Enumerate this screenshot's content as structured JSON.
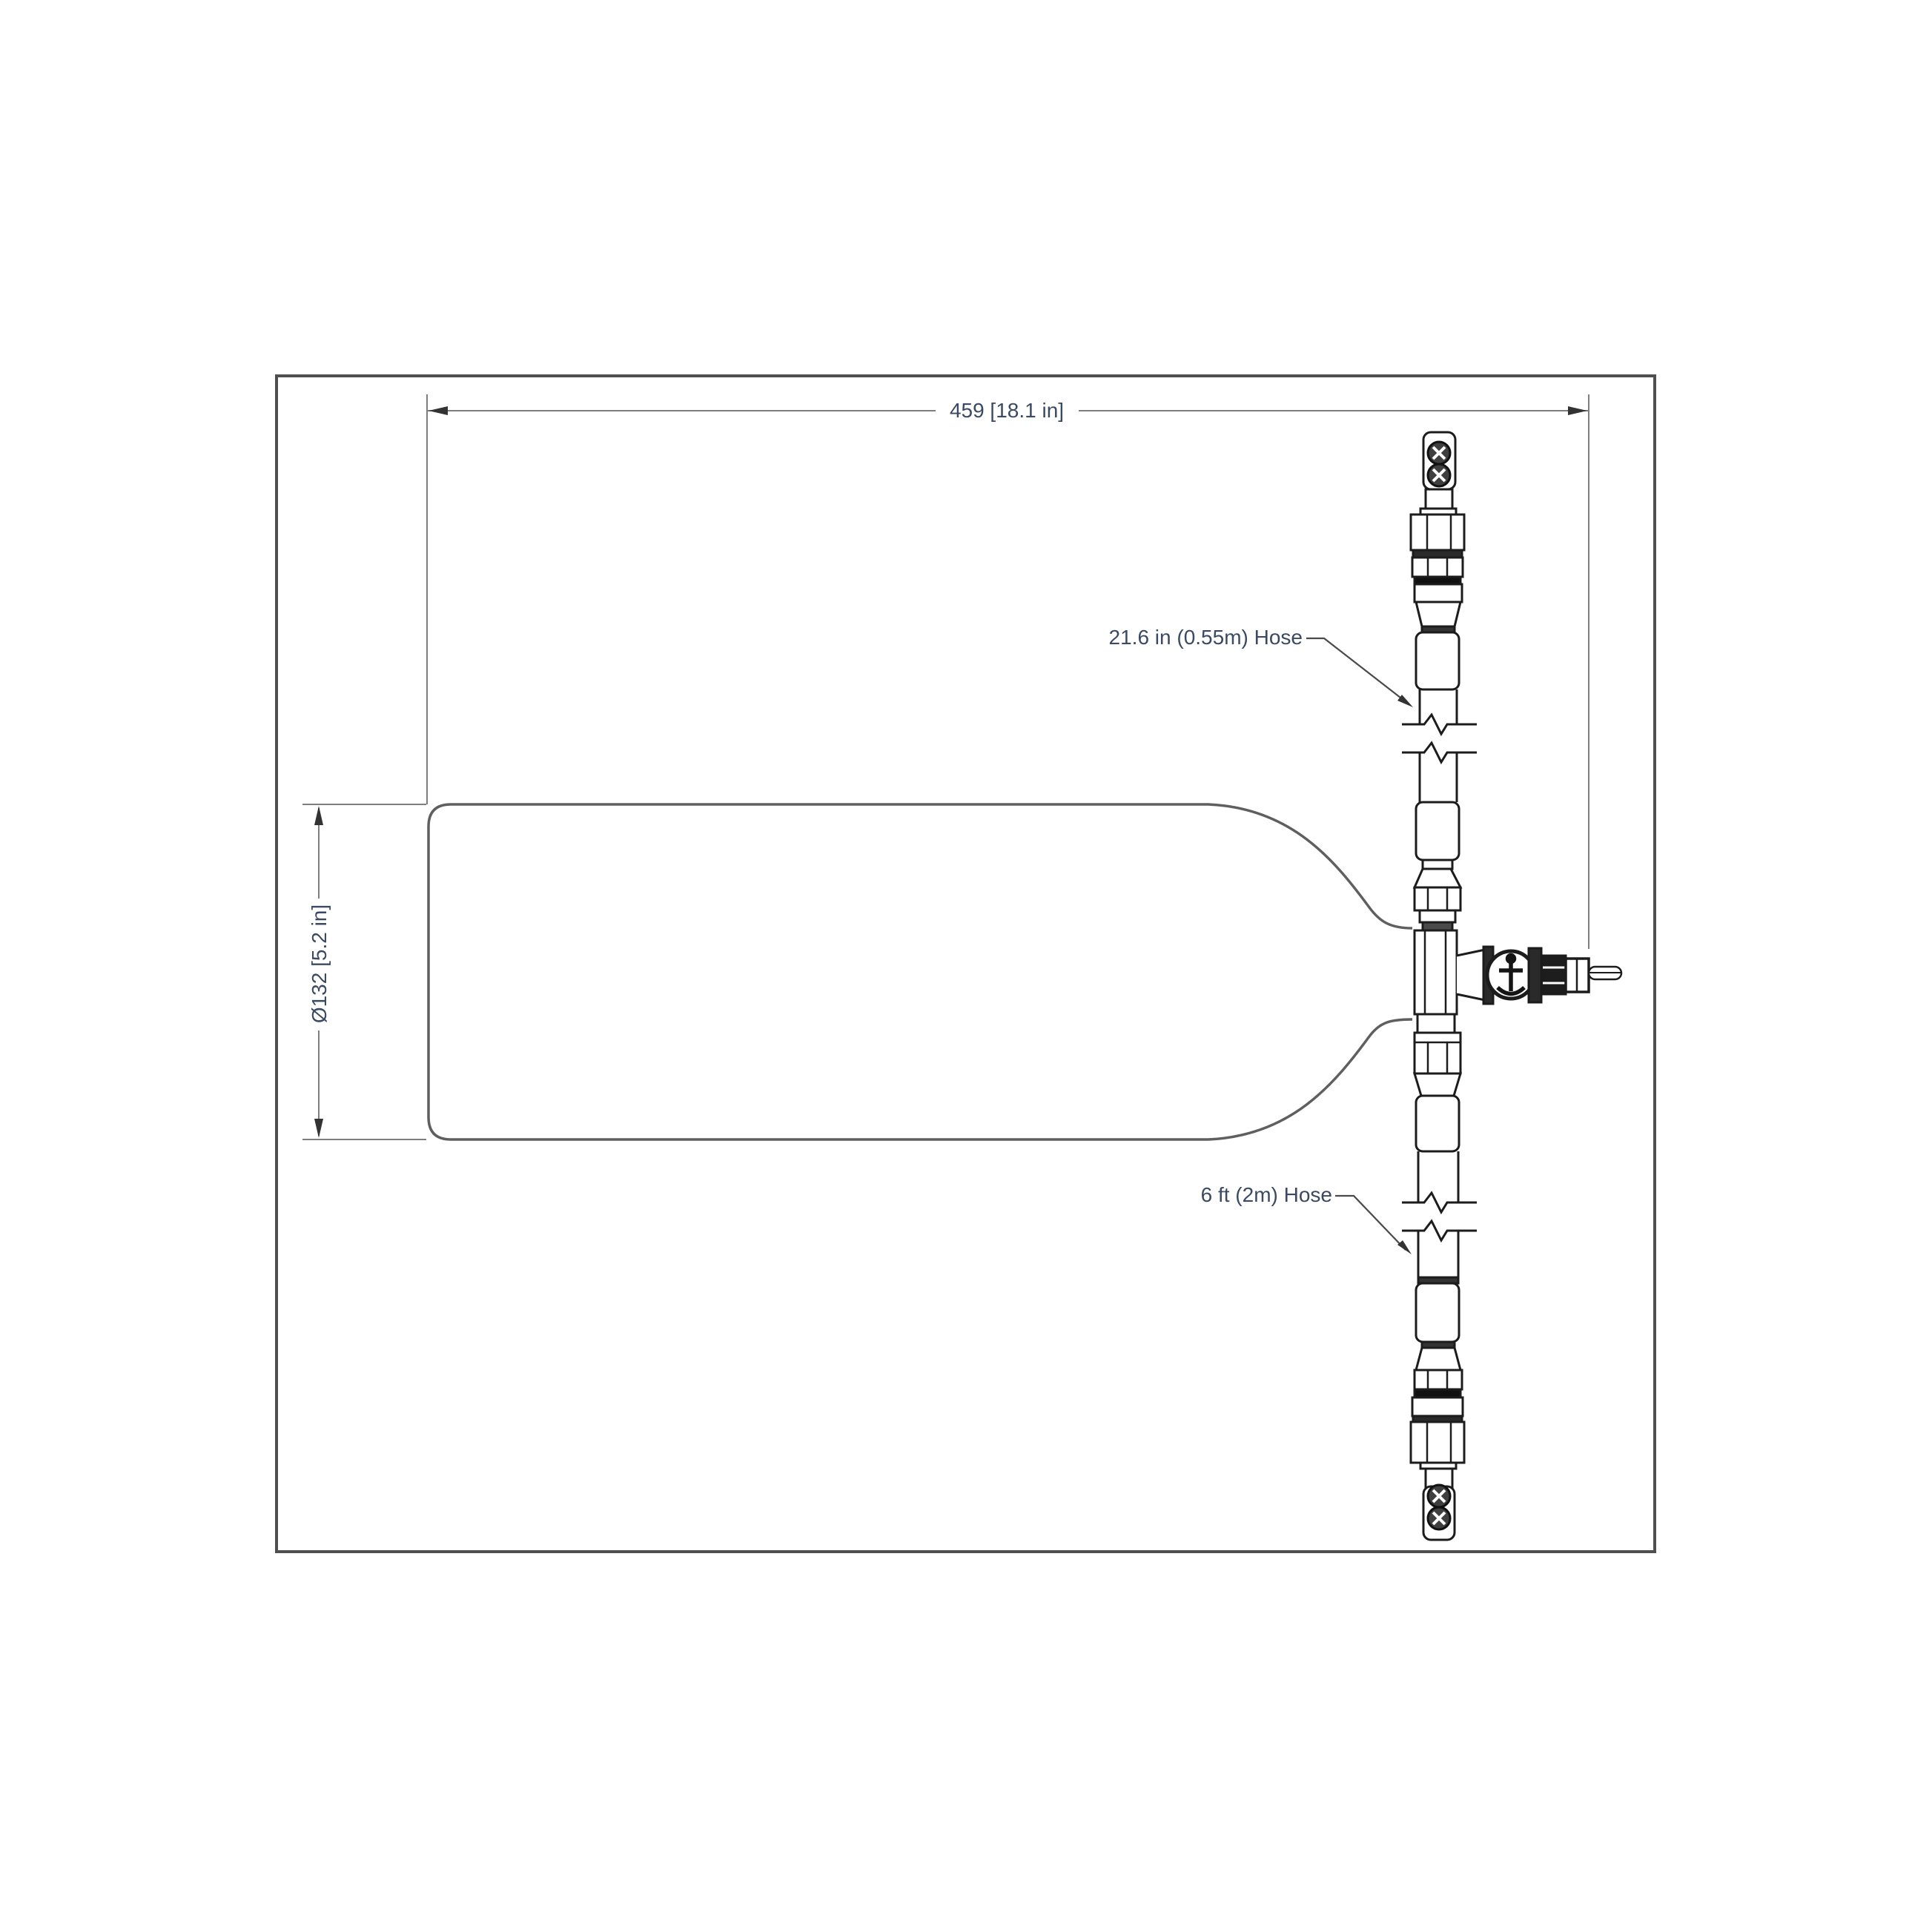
{
  "labels": {
    "dim_width": "459 [18.1 in]",
    "dim_diameter": "Ø132 [5.2 in]",
    "hose_short": "21.6 in (0.55m) Hose",
    "hose_long": "6 ft (2m) Hose"
  },
  "colors": {
    "background": "#ffffff",
    "frame": "#4f4f4f",
    "outline": "#1c1c1c",
    "cylinder": "#5f5f5f",
    "dimension": "#7e7e7e",
    "text": "#3b4a63"
  }
}
